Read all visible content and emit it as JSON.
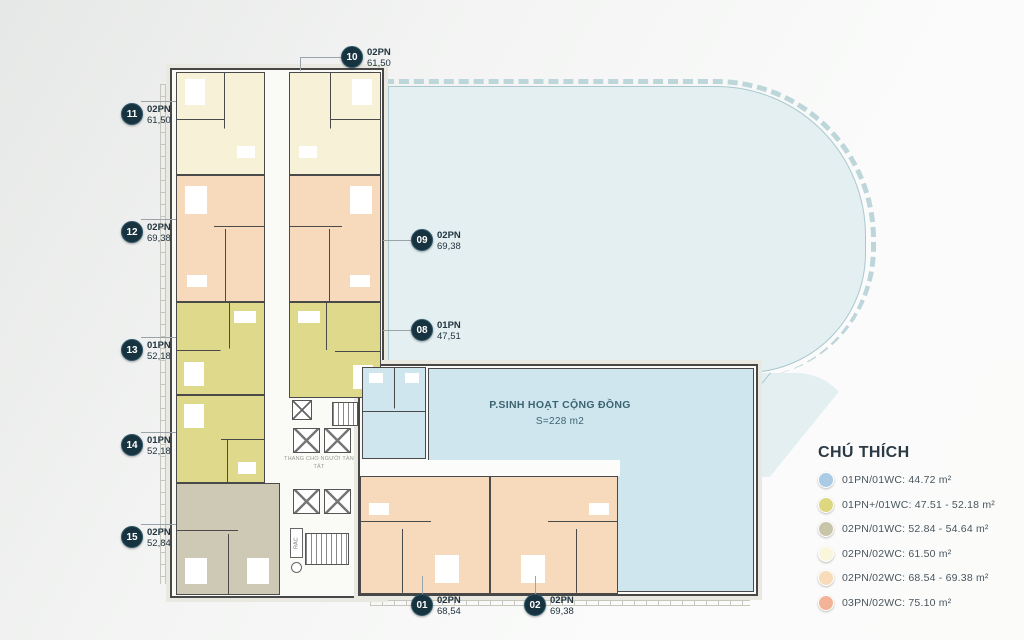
{
  "colors": {
    "label_circle": "#17333f",
    "deck": "#e4eff1",
    "community_blue": "#cfe6ef",
    "unit_cream": "#f6f1d7",
    "unit_peach": "#f7d9bb",
    "unit_yellow": "#ded98b",
    "unit_gray": "#cdc9b4",
    "legend_blue": "#a9cbe4",
    "legend_yellow": "#ddd77f",
    "legend_gray": "#c9c5a9",
    "legend_cream": "#faf6dc",
    "legend_peach": "#f8dcba",
    "legend_salmon": "#f2b396"
  },
  "units": [
    {
      "id": "01",
      "type": "02PN",
      "area": "68,54"
    },
    {
      "id": "02",
      "type": "02PN",
      "area": "69,38"
    },
    {
      "id": "08",
      "type": "01PN",
      "area": "47,51"
    },
    {
      "id": "09",
      "type": "02PN",
      "area": "69,38"
    },
    {
      "id": "10",
      "type": "02PN",
      "area": "61,50"
    },
    {
      "id": "11",
      "type": "02PN",
      "area": "61,50"
    },
    {
      "id": "12",
      "type": "02PN",
      "area": "69,38"
    },
    {
      "id": "13",
      "type": "01PN",
      "area": "52,18"
    },
    {
      "id": "14",
      "type": "01PN",
      "area": "52,18"
    },
    {
      "id": "15",
      "type": "02PN",
      "area": "52,84"
    }
  ],
  "community_room": {
    "name": "P.SINH HOẠT CỘNG ĐỒNG",
    "area": "S=228 m2"
  },
  "core": {
    "elevator_note": "THANG CHO NGƯỜI TÀN TẬT",
    "trash_label": "RÁC"
  },
  "legend": {
    "title": "CHÚ THÍCH",
    "items": [
      {
        "label": "01PN/01WC: 44.72 m²"
      },
      {
        "label": "01PN+/01WC: 47.51 - 52.18 m²"
      },
      {
        "label": "02PN/01WC: 52.84 - 54.64 m²"
      },
      {
        "label": "02PN/02WC: 61.50 m²"
      },
      {
        "label": "02PN/02WC: 68.54 - 69.38 m²"
      },
      {
        "label": "03PN/02WC: 75.10 m²"
      }
    ]
  }
}
